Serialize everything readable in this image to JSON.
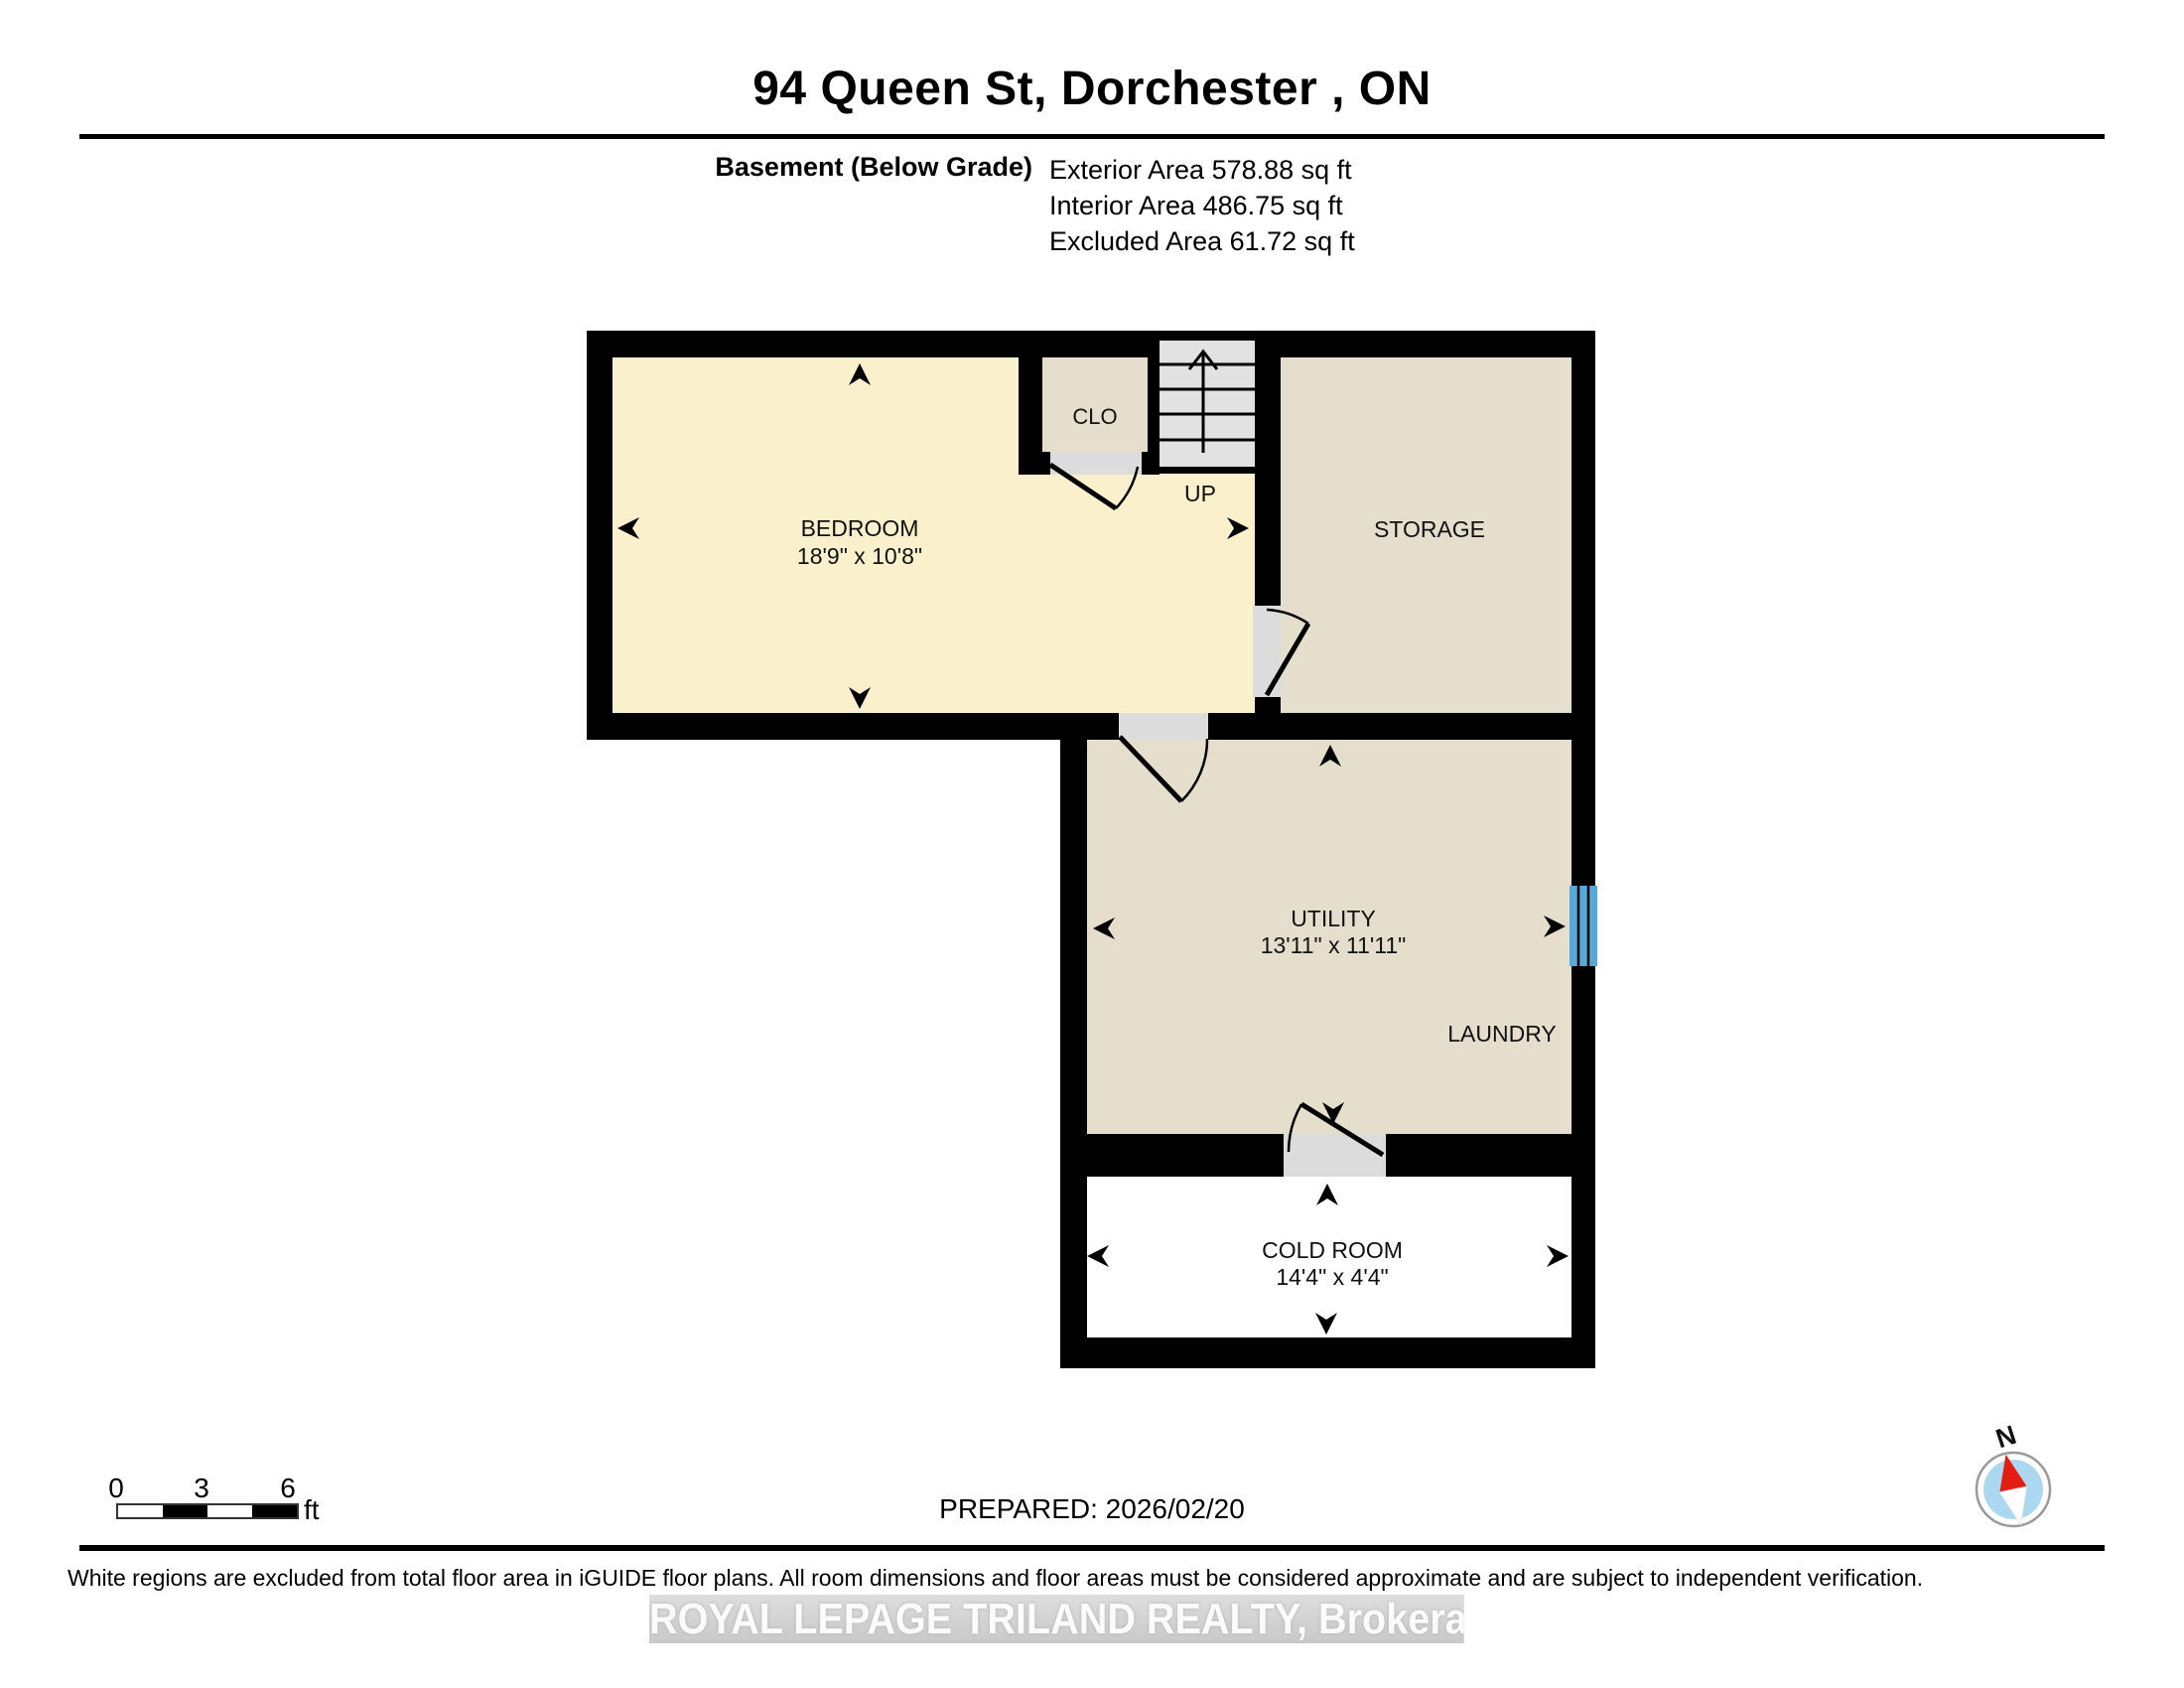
{
  "header": {
    "title": "94 Queen St, Dorchester , ON",
    "floor_label": "Basement (Below Grade)",
    "area_lines": [
      "Exterior Area 578.88 sq ft",
      "Interior Area 486.75 sq ft",
      "Excluded Area 61.72 sq ft"
    ]
  },
  "plan": {
    "rooms": {
      "bedroom": {
        "name": "BEDROOM",
        "dims": "18'9\" x 10'8\""
      },
      "closet": {
        "name": "CLO"
      },
      "storage": {
        "name": "STORAGE"
      },
      "utility": {
        "name": "UTILITY",
        "dims": "13'11\" x 11'11\""
      },
      "laundry": {
        "name": "LAUNDRY"
      },
      "cold_room": {
        "name": "COLD ROOM",
        "dims": "14'4\" x 4'4\""
      }
    },
    "stairs_label": "UP",
    "colors": {
      "included_floor": "#fbf0cc",
      "room_floor": "#e6decc",
      "excluded_floor": "#ffffff",
      "stairs": "#e2e2e2",
      "door_opening": "#dcdcdc",
      "wall": "#000000",
      "window": "#55a9db",
      "compass_blue": "#abd7f0",
      "compass_red": "#e41d13"
    }
  },
  "scale_bar": {
    "ticks": [
      "0",
      "3",
      "6"
    ],
    "unit": "ft"
  },
  "footer": {
    "prepared": "PREPARED: 2026/02/20",
    "disclaimer": "White regions are excluded from total floor area in iGUIDE floor plans. All room dimensions and floor areas must be considered approximate and are subject to independent verification.",
    "watermark": "ROYAL LEPAGE TRILAND REALTY, Brokerage"
  },
  "compass": {
    "label": "N"
  }
}
